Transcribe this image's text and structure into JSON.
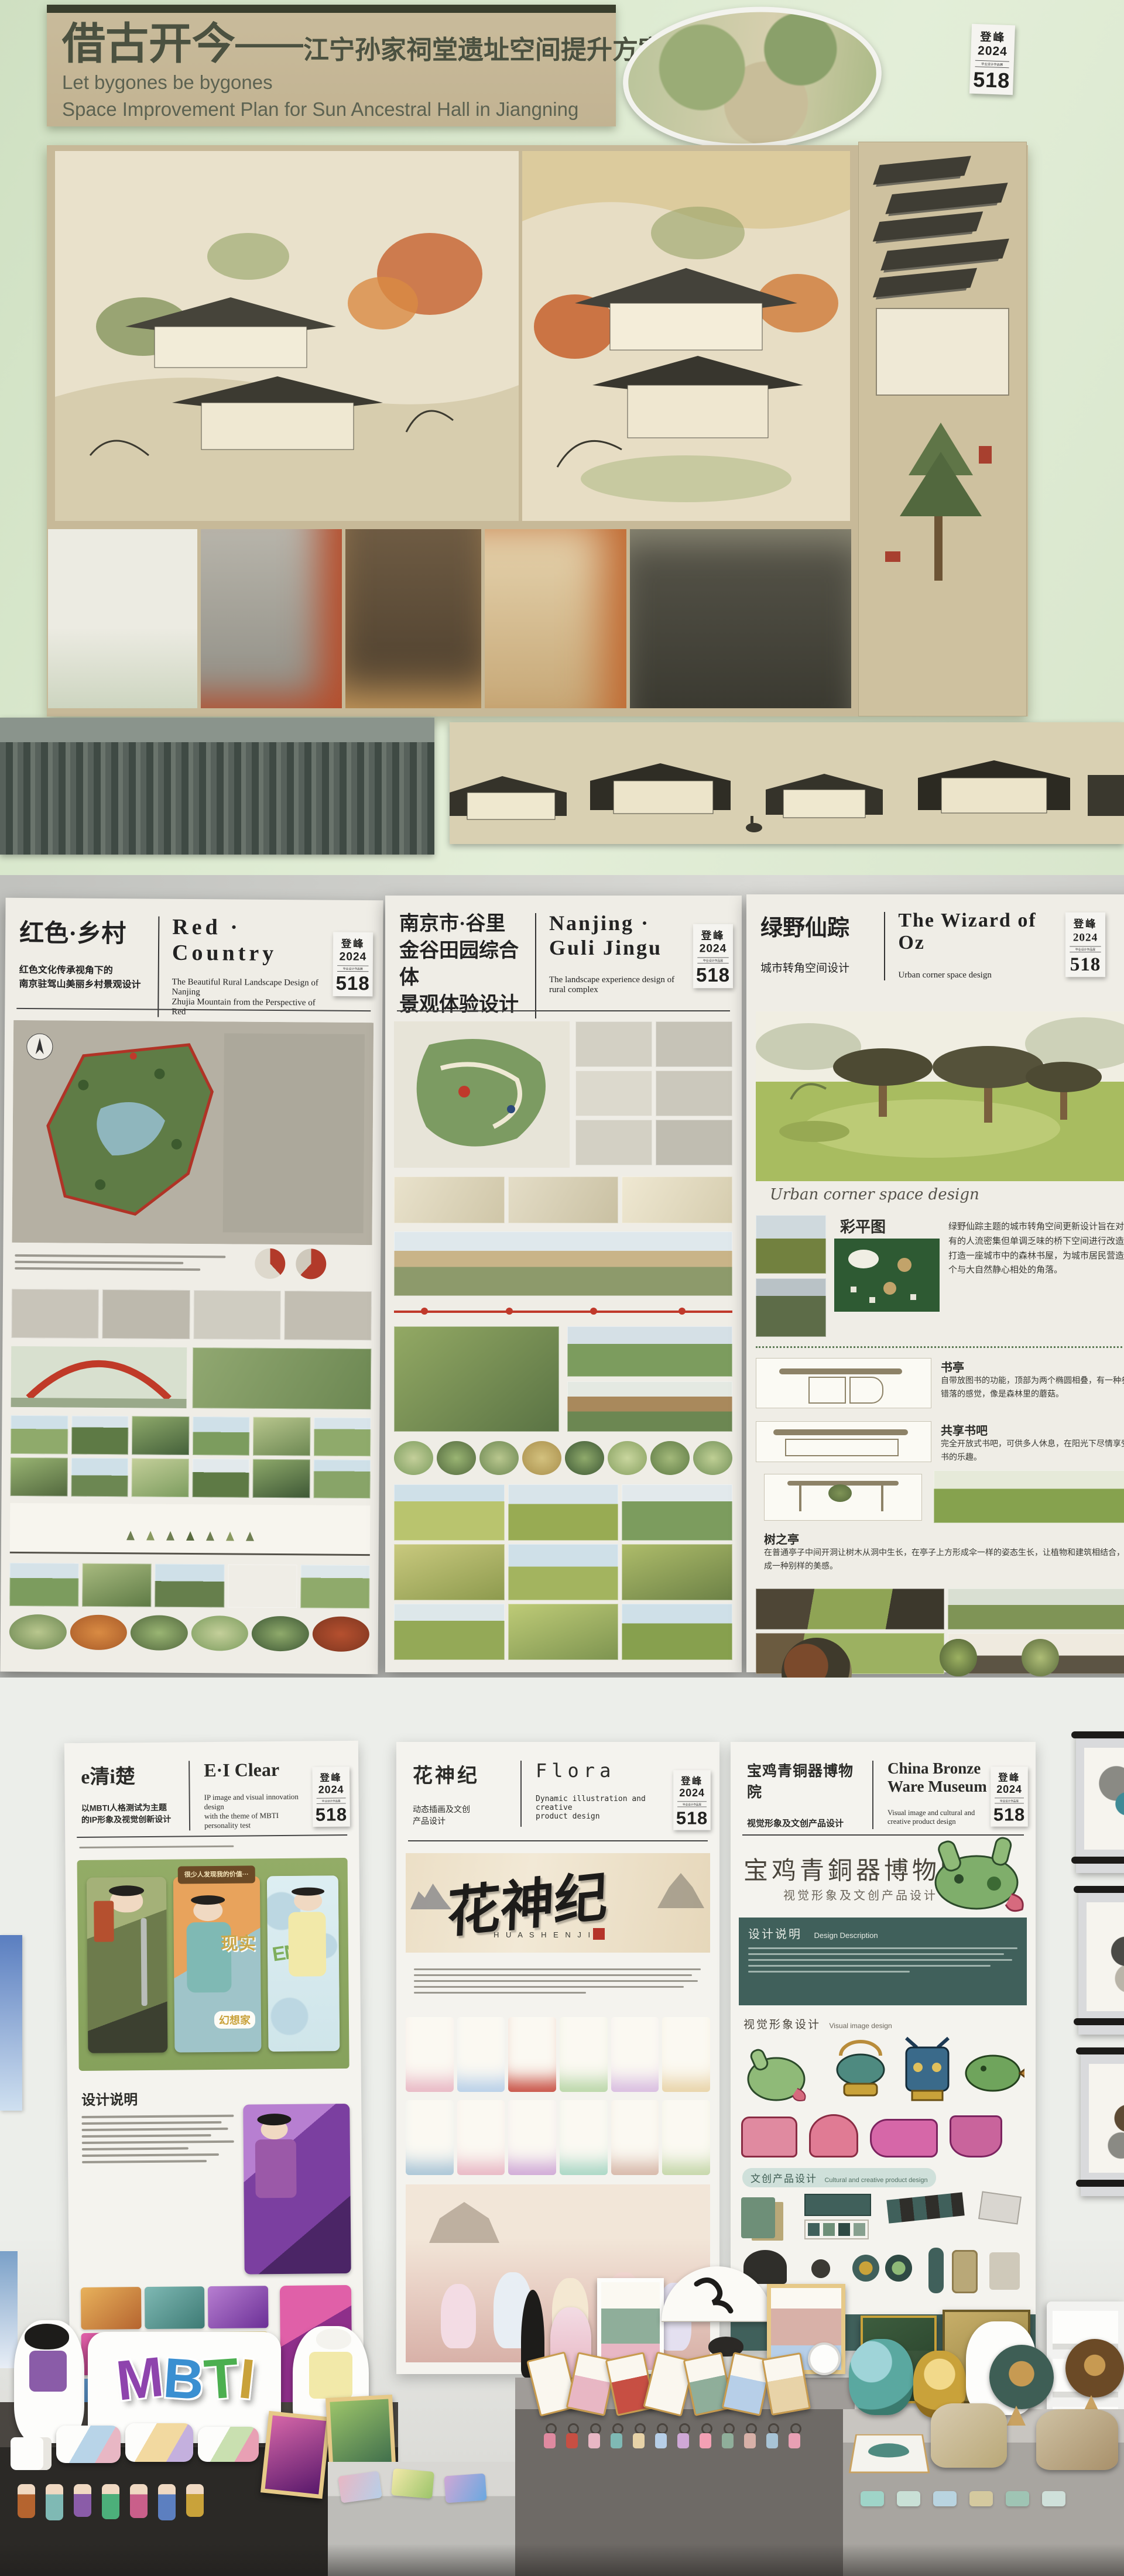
{
  "badge": {
    "zh": "登峰",
    "year": "2024",
    "small": "毕业设计作品展",
    "num": "518"
  },
  "top_board": {
    "title_zh": "借古开今",
    "title_dash": "——",
    "title_sub": "江宁孙家祠堂遗址空间提升方案",
    "title_en1": "Let bygones be bygones",
    "title_en2": "Space Improvement Plan for Sun Ancestral Hall in Jiangning"
  },
  "posters": {
    "red_country": {
      "zh": "红色·乡村",
      "en": "Red · Country",
      "sub_zh1": "红色文化传承视角下的",
      "sub_zh2": "南京驻驾山美丽乡村景观设计",
      "sub_en1": "The Beautiful Rural Landscape Design of Nanjing",
      "sub_en2": "Zhujia Mountain from the Perspective of Red"
    },
    "guli": {
      "zh1": "南京市·谷里",
      "zh2": "金谷田园综合体",
      "zh3": "景观体验设计",
      "en": "Nanjing · Guli Jingu",
      "sub_en1": "The landscape experience design of",
      "sub_en2": "rural complex"
    },
    "wizard": {
      "zh": "绿野仙踪",
      "en": "The Wizard of Oz",
      "sub_zh": "城市转角空间设计",
      "sub_en": "Urban corner space design",
      "script": "Urban corner space design",
      "quote_mark": "「",
      "sections": [
        {
          "title": "彩平图",
          "text": "绿野仙踪主题的城市转角空间更新设计旨在对现有的人流密集但单调乏味的桥下空间进行改造，打造一座城市中的森林书屋，为城市居民营造一个与大自然静心相处的角落。"
        },
        {
          "title": "书亭",
          "text": "自带放图书的功能，顶部为两个椭圆相叠，有一种参差错落的感觉，像是森林里的蘑菇。"
        },
        {
          "title": "共享书吧",
          "text": "完全开放式书吧，可供多人休息，在阳光下尽情享受读书的乐趣。"
        },
        {
          "title": "树之亭",
          "text": "在普通亭子中间开洞让树木从洞中生长，在亭子上方形成伞一样的姿态生长，让植物和建筑相结合，形成一种别样的美感。"
        }
      ]
    },
    "ei_clear": {
      "zh": "e清i楚",
      "en": "E·I Clear",
      "sub_zh1": "以MBTI人格测试为主题",
      "sub_zh2": "的IP形象及视觉创新设计",
      "sub_en1": "IP image and visual innovation design",
      "sub_en2": "with the theme of MBTI personality test",
      "design_note": "设计说明",
      "card_banner": "很少人发现我的价值···",
      "card_word1": "现实",
      "card_word2": "幻想家",
      "card_letters": "ENFP"
    },
    "flora": {
      "zh": "花神纪",
      "en": "Flora",
      "sub_zh1": "动态插画及文创",
      "sub_zh2": "产品设计",
      "sub_en1": "Dynamic illustration and creative",
      "sub_en2": "product design",
      "logo": "花神纪",
      "logo_latin": "H U A S H E N J I"
    },
    "bronze": {
      "zh": "宝鸡青铜器博物院",
      "en": "China Bronze Ware Museum",
      "sub_zh": "视觉形象及文创产品设计",
      "sub_en": "Visual image and cultural and creative product design",
      "calligraphy": "宝鸡青銅器博物院",
      "calligraphy_sub": "视觉形象及文创产品设计",
      "s1_zh": "设计说明",
      "s1_en": "Design Description",
      "s2_zh": "视觉形象设计",
      "s2_en": "Visual image design",
      "s3_zh": "文创产品设计",
      "s3_en": "Cultural and creative product design"
    }
  },
  "merch": {
    "mbti_letters": [
      "M",
      "B",
      "T",
      "I"
    ]
  }
}
